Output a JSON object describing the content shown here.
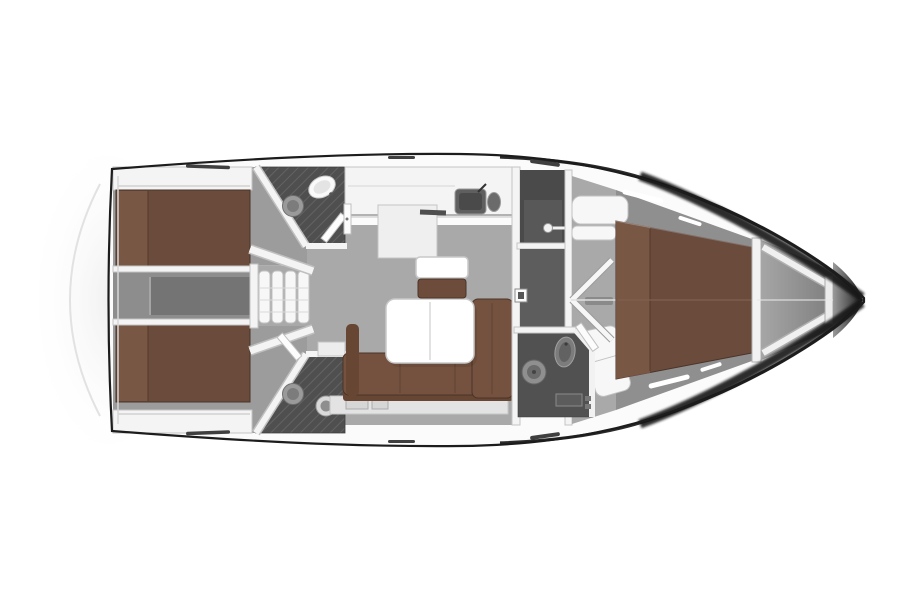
{
  "page": {
    "background": "#ffffff",
    "description": "Top-down interior floor plan of a sailing yacht (no visible text labels in image)"
  },
  "plan": {
    "type": "yacht-floor-plan",
    "orientation": "bow-right-stern-left",
    "rooms": [
      "aft-cabin-port",
      "aft-cabin-starboard",
      "engine-compartment",
      "companionway-steps",
      "aft-head-port",
      "aft-head-starboard",
      "galley",
      "salon",
      "midship-locker",
      "corridor",
      "forward-head",
      "forward-cabin",
      "anchor-locker"
    ],
    "furniture": [
      "double-berth-port",
      "double-berth-starboard",
      "l-shaped-sofa",
      "folding-salon-table",
      "settee-with-table",
      "galley-sink",
      "toilet-x3",
      "washbasin-x3",
      "v-berth",
      "companionway-steps"
    ]
  },
  "colors": {
    "hullStroke": "#1c1c1c",
    "deckWhite": "#fbfbfb",
    "wallWhite": "#f4f4f4",
    "wallEdge": "#c4c4c4",
    "innerLine": "#d6d6d6",
    "floorGray": "#a9a9a9",
    "cabinGray": "#9c9c9c",
    "engineGray": "#8d8d8d",
    "engineDark": "#747474",
    "headDark": "#4f4f4f",
    "hatchLine": "#636363",
    "corridorDark": "#5d5d5d",
    "roomDark": "#4a4a4a",
    "fwdHeadGray": "#515151",
    "bedBrown": "#6b4b3c",
    "bedBrownLight": "#7b5947",
    "bedEdge": "#4a3428",
    "sofaBrown": "#75523f",
    "sofaBrownDark": "#674634",
    "benchBrown": "#6e4c3c",
    "tableWhite": "#ffffff",
    "furnWhite": "#f7f7f7",
    "fixtureGray": "#8f8f8f",
    "sinkDark": "#5f5f5f",
    "bandDark": "#1f1f1f",
    "tipDark": "#181818",
    "platformLine": "#e2e2e2"
  }
}
